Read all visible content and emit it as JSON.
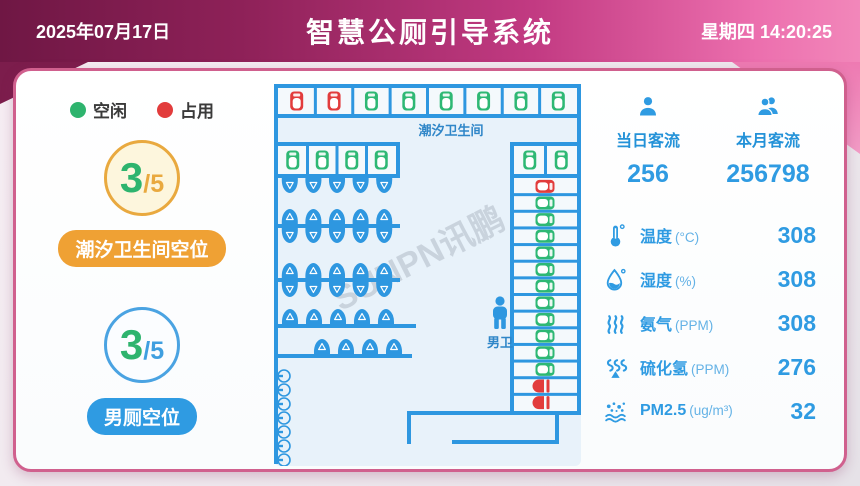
{
  "header": {
    "date": "2025年07月17日",
    "title": "智慧公厕引导系统",
    "weekday_time": "星期四 14:20:25"
  },
  "legend": {
    "free_label": "空闲",
    "busy_label": "占用"
  },
  "tidal": {
    "free": "3",
    "total": "/5",
    "label": "潮汐卫生间空位"
  },
  "male": {
    "free": "3",
    "total": "/5",
    "label": "男厕空位"
  },
  "traffic": {
    "today_label": "当日客流",
    "today_value": "256",
    "month_label": "本月客流",
    "month_value": "256798"
  },
  "sensors": [
    {
      "icon": "thermometer-icon",
      "label": "温度",
      "unit": "(°C)",
      "value": "308"
    },
    {
      "icon": "droplet-icon",
      "label": "湿度",
      "unit": "(%)",
      "value": "308"
    },
    {
      "icon": "ammonia-icon",
      "label": "氨气",
      "unit": "(PPM)",
      "value": "308"
    },
    {
      "icon": "h2s-icon",
      "label": "硫化氢",
      "unit": "(PPM)",
      "value": "276"
    },
    {
      "icon": "pm25-icon",
      "label": "PM2.5",
      "unit": "(ug/m³)",
      "value": "32"
    }
  ],
  "map": {
    "area_label": "潮汐卫生间",
    "male_label": "男卫",
    "watermark": "SUNPN讯鹏",
    "colors": {
      "wall": "#2e97e0",
      "free": "#2eb874",
      "busy": "#e23c3c",
      "cell_bg": "#f4f9fc",
      "floor_bg": "#e8f2fa",
      "label": "#2f86c8"
    },
    "top_row": [
      "busy",
      "busy",
      "free",
      "free",
      "free",
      "free",
      "free",
      "free"
    ],
    "row2_left": [
      "free",
      "free",
      "free",
      "free"
    ],
    "row2_right": [
      "free",
      "free"
    ],
    "right_column": [
      "busy",
      "free",
      "free",
      "free",
      "free",
      "free",
      "free",
      "free",
      "free",
      "free",
      "free",
      "free",
      "squat_busy",
      "squat_busy"
    ],
    "urinal_rows": [
      {
        "up": 0,
        "down": 5
      },
      {
        "up": 5,
        "down": 5
      },
      {
        "up": 5,
        "down": 5
      },
      {
        "up": 5,
        "down": 0
      },
      {
        "up": 4,
        "down": 0
      }
    ],
    "sink_count": 7
  },
  "ui_colors": {
    "header_dark": "#6f1744",
    "header_pink": "#f287ba",
    "panel_border": "#d0608e",
    "accent_blue": "#2f9be2",
    "free_green": "#2eb46e",
    "busy_red": "#e23c3c",
    "tidal_orange": "#efa134"
  }
}
